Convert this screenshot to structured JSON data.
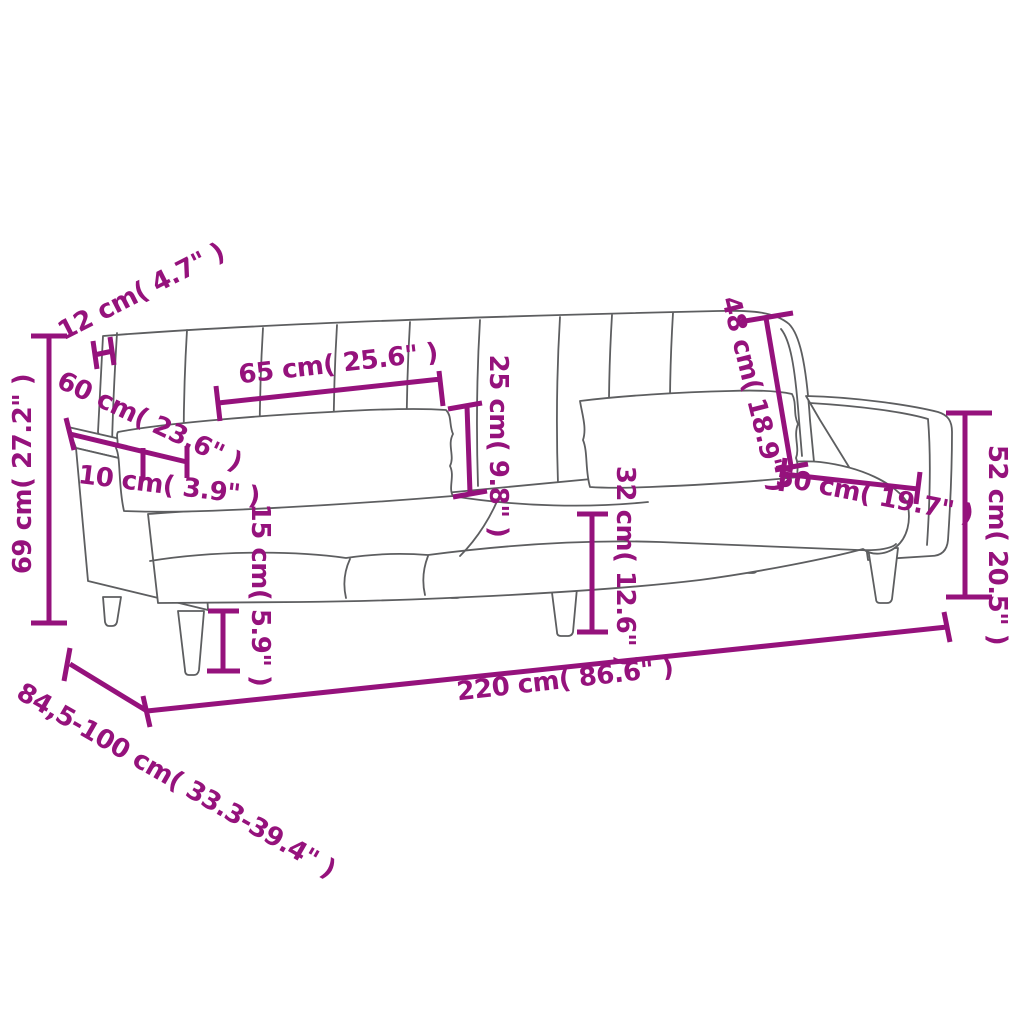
{
  "diagram": {
    "type": "product-dimension-diagram",
    "subject": "sofa-bed line drawing with measurement annotations",
    "colors": {
      "dimension_annotation": "#95127c",
      "product_outline": "#5d5e60",
      "background": "#ffffff"
    },
    "dimensions": [
      {
        "id": "backrest-thickness",
        "label": "12 cm( 4.7\" )"
      },
      {
        "id": "backrest-panel-width",
        "label": "65 cm( 25.6\" )"
      },
      {
        "id": "pillow-height",
        "label": "25 cm( 9.8\" )"
      },
      {
        "id": "backrest-height",
        "label": "48 cm( 18.9\" )"
      },
      {
        "id": "armrest-depth",
        "label": "60 cm( 23.6\" )"
      },
      {
        "id": "armrest-width",
        "label": "10 cm( 3.9\" )"
      },
      {
        "id": "total-height",
        "label": "69 cm( 27.2\" )"
      },
      {
        "id": "armrest-height",
        "label": "52 cm( 20.5\" )"
      },
      {
        "id": "seat-depth",
        "label": "50 cm( 19.7\" )"
      },
      {
        "id": "seat-height",
        "label": "32 cm( 12.6\" )"
      },
      {
        "id": "leg-height",
        "label": "15 cm( 5.9\" )"
      },
      {
        "id": "total-width",
        "label": "220 cm( 86.6\" )"
      },
      {
        "id": "total-depth",
        "label": "84,5-100 cm( 33.3-39.4\" )"
      }
    ]
  }
}
